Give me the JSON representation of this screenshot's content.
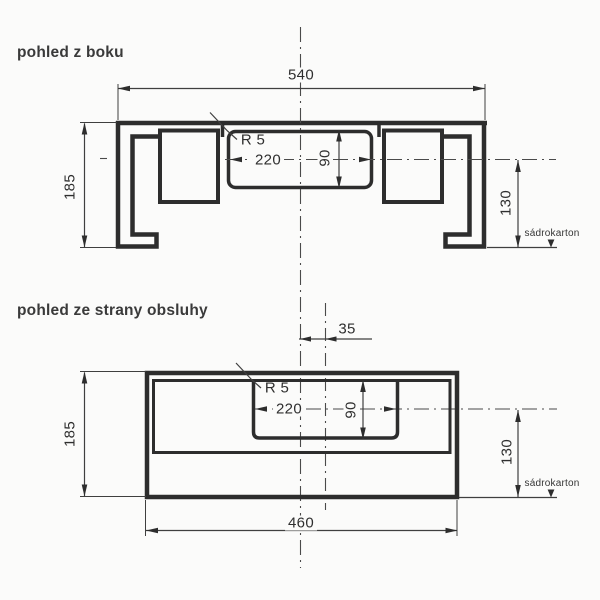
{
  "colors": {
    "background": "#fbfbfa",
    "outline": "#2d2d2d",
    "dimension_line": "#3f3f3f",
    "text": "#2f2f2f"
  },
  "side_view": {
    "title": "pohled z boku",
    "overall_width": "540",
    "overall_height": "185",
    "cutout_width": "220",
    "cutout_height": "90",
    "corner_radius": "R 5",
    "board_offset": "130",
    "board_label": "sádrokarton"
  },
  "front_view": {
    "title": "pohled ze strany obsluhy",
    "overall_width": "460",
    "overall_height": "185",
    "cutout_width": "220",
    "cutout_height": "90",
    "corner_radius": "R 5",
    "board_offset": "130",
    "center_offset": "35",
    "board_label": "sádrokarton"
  }
}
